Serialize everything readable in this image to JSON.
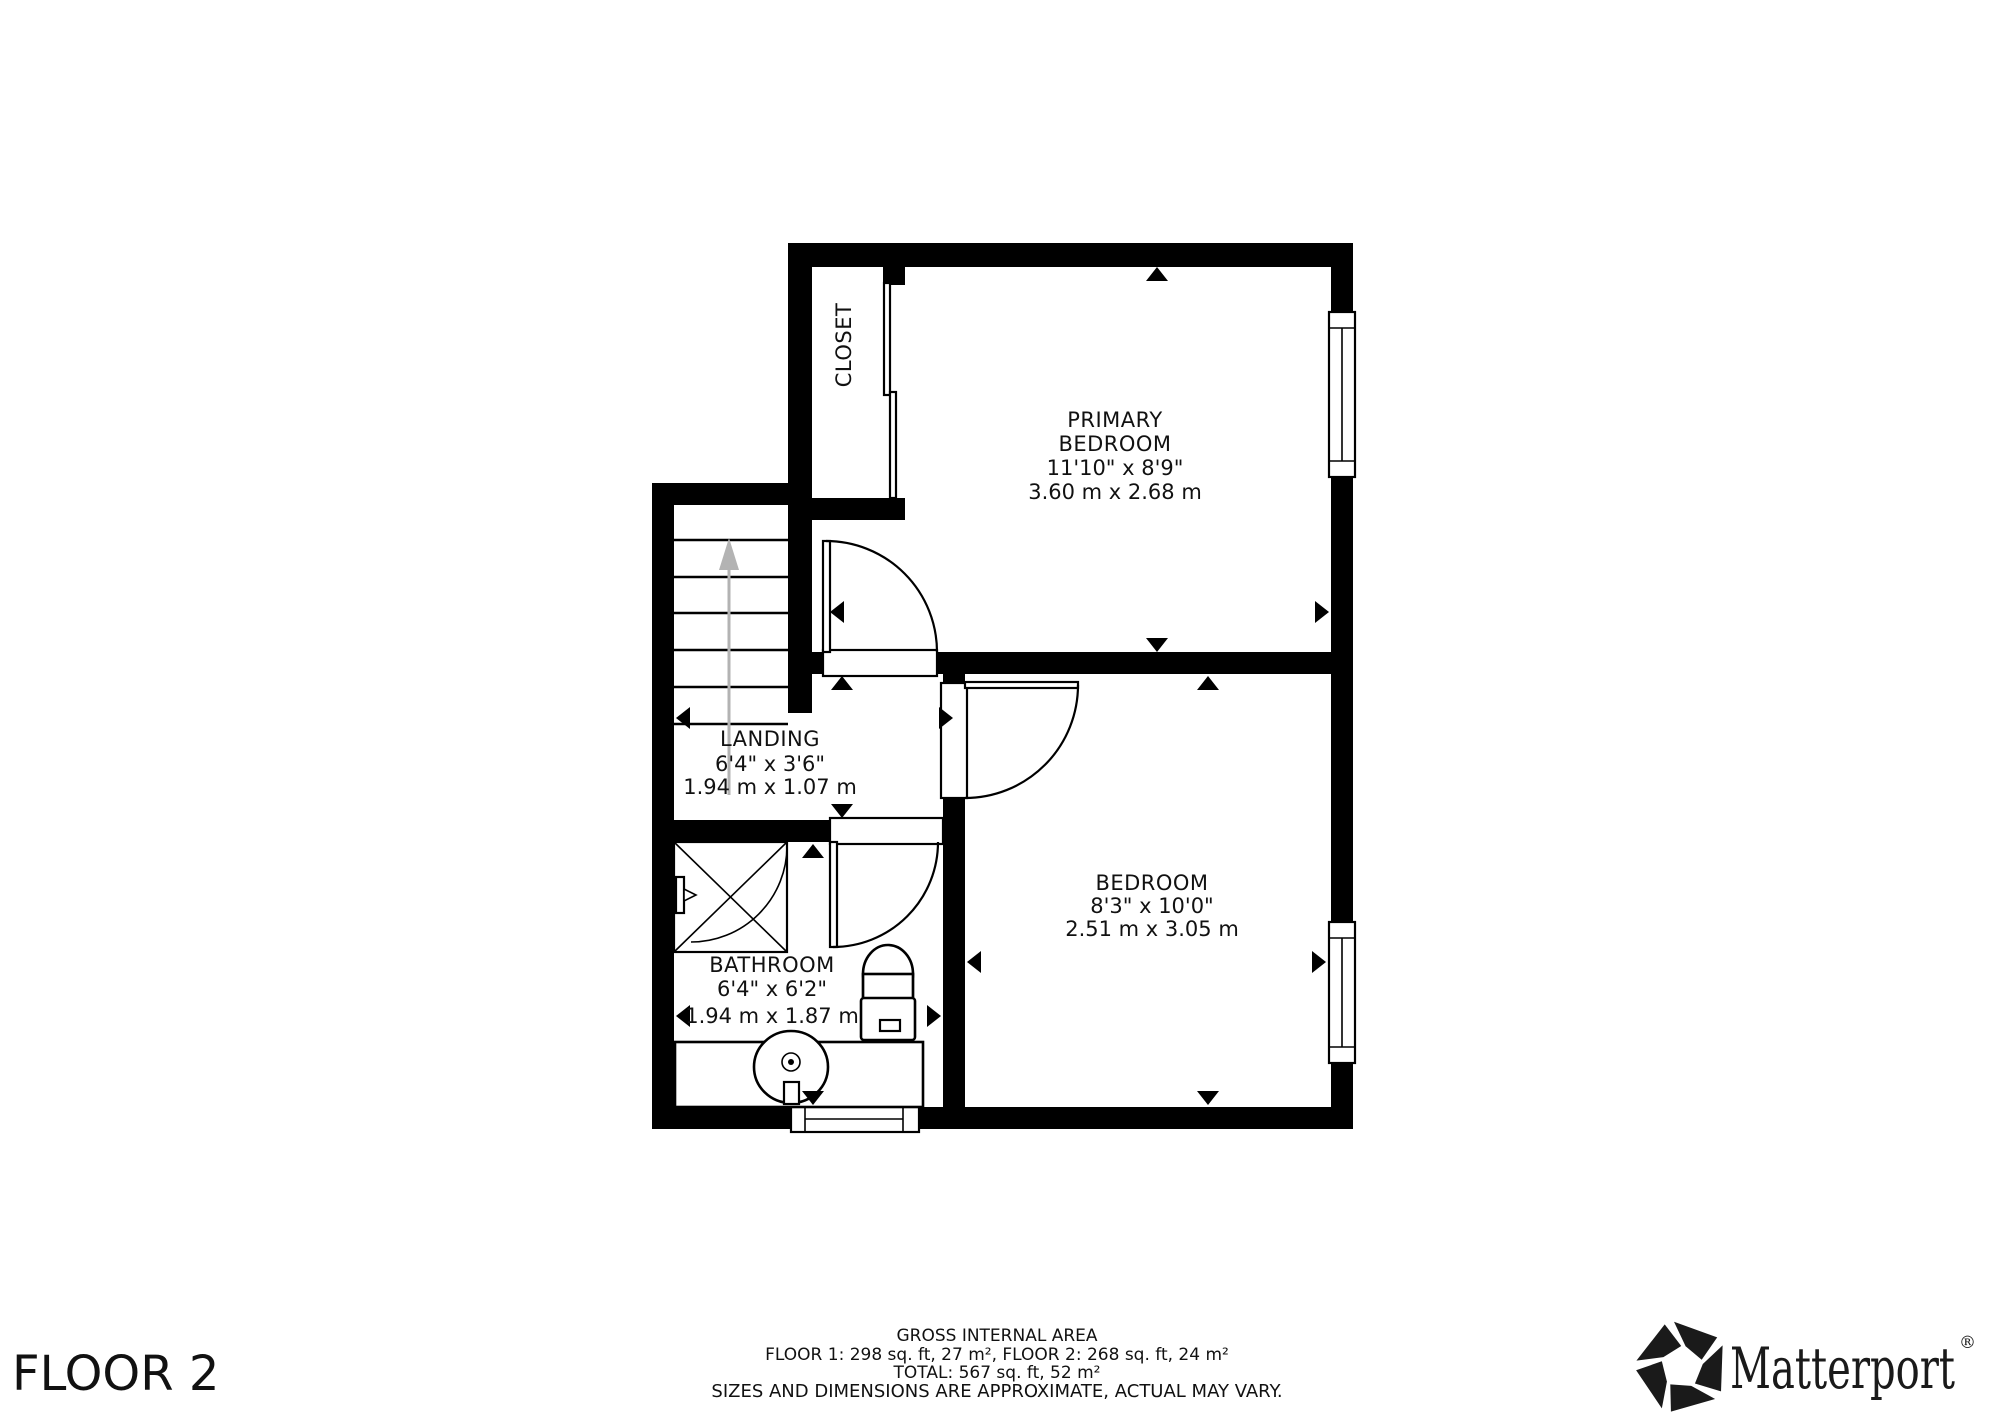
{
  "floor": {
    "label": "FLOOR 2"
  },
  "rooms": {
    "closet": {
      "label": "CLOSET"
    },
    "primary_bedroom": {
      "label_line1": "PRIMARY",
      "label_line2": "BEDROOM",
      "imperial": "11'10\" x 8'9\"",
      "metric": "3.60 m x 2.68 m"
    },
    "landing": {
      "label": "LANDING",
      "imperial": "6'4\" x 3'6\"",
      "metric": "1.94 m x 1.07 m"
    },
    "bathroom": {
      "label": "BATHROOM",
      "imperial": "6'4\" x 6'2\"",
      "metric": "1.94 m x 1.87 m"
    },
    "bedroom": {
      "label": "BEDROOM",
      "imperial": "8'3\" x 10'0\"",
      "metric": "2.51 m x 3.05 m"
    }
  },
  "footer": {
    "title": "GROSS INTERNAL AREA",
    "line1": "FLOOR 1: 298 sq. ft, 27 m², FLOOR 2: 268 sq. ft, 24 m²",
    "line2": "TOTAL: 567 sq. ft, 52 m²",
    "disclaimer": "SIZES AND DIMENSIONS ARE APPROXIMATE, ACTUAL MAY VARY."
  },
  "branding": {
    "logo_text": "Matterport",
    "registered_mark": "®"
  },
  "colors": {
    "wall": "#000000",
    "stair_arrow": "#b3b3b3",
    "muted_text": "#9b9b9b",
    "logo": "#1a1a1a"
  }
}
